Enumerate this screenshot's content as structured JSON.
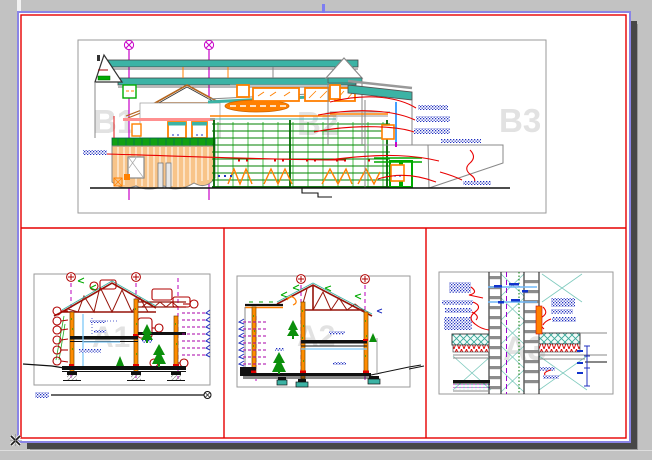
{
  "window": {
    "background_color": "#c2c2c2",
    "shadow_color": "#474747",
    "grip_color": "#7d7df2"
  },
  "paper": {
    "fill": "#ffffff",
    "frame_border_color": "#8a85e6",
    "margin_line_color": "#e60000"
  },
  "watermarks": {
    "elevation_left": "B1",
    "elevation_mid": "B2",
    "elevation_right": "B3",
    "section_1": "A1",
    "section_2": "A2",
    "detail_3": "A3"
  },
  "palette": {
    "roof_teal": "#3cb3a5",
    "structure_green": "#008000",
    "wall_orange": "#ff8000",
    "wall_fill": "#f8c489",
    "truss_dark_red": "#96140a",
    "grid_magenta": "#c800c8",
    "annotation_blue": "#2030c0",
    "dimension_cyan": "#7ec8f8",
    "leader_red": "#e80000",
    "border_gray": "#9a9a9a"
  },
  "panels": [
    {
      "id": "elevation",
      "kind": "building-elevation"
    },
    {
      "id": "section-a1",
      "kind": "cross-section"
    },
    {
      "id": "section-a2",
      "kind": "cross-section"
    },
    {
      "id": "detail-a3",
      "kind": "wall-section-detail"
    }
  ]
}
